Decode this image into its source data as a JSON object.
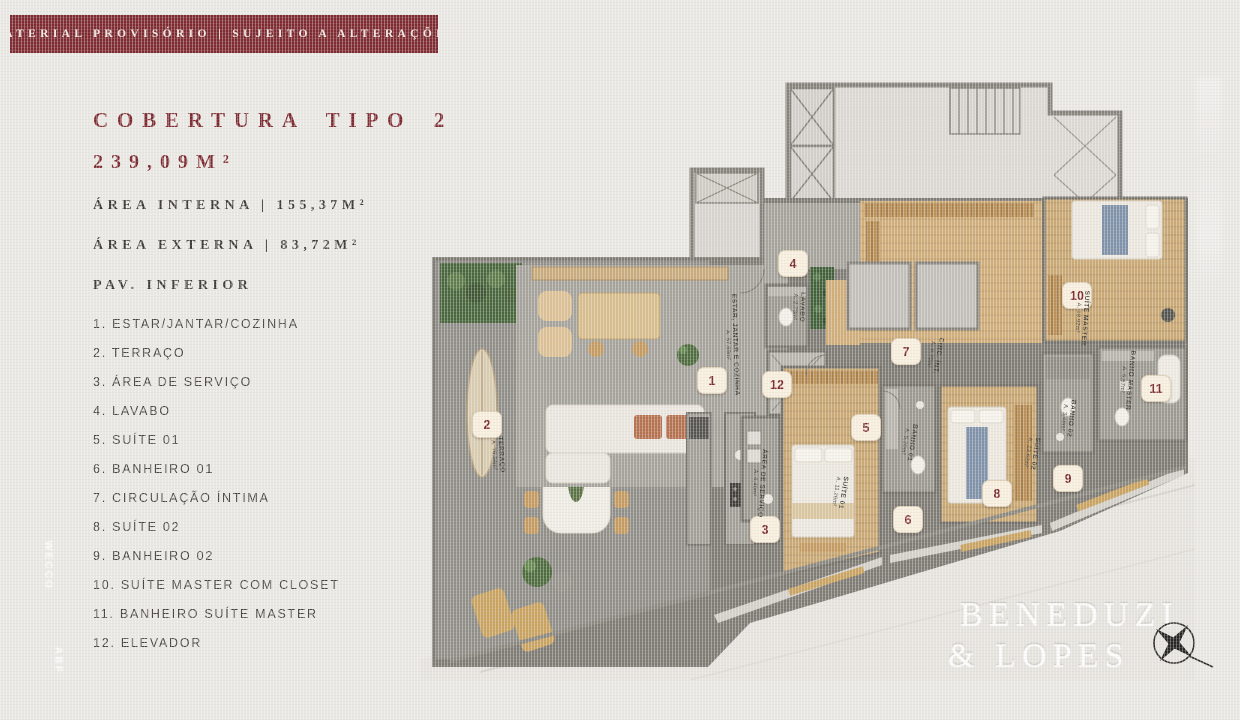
{
  "banner": {
    "text": "MATERIAL PROVISÓRIO | SUJEITO A ALTERAÇÕES"
  },
  "header": {
    "title": "COBERTURA TIPO 2",
    "total_area": "239,09M²",
    "area_interna": "ÁREA INTERNA | 155,37M²",
    "area_externa": "ÁREA EXTERNA | 83,72M²",
    "floor": "PAV. INFERIOR"
  },
  "legend": {
    "items": [
      {
        "num": "1.",
        "label": "ESTAR/JANTAR/COZINHA"
      },
      {
        "num": "2.",
        "label": "TERRAÇO"
      },
      {
        "num": "3.",
        "label": "ÁREA DE SERVIÇO"
      },
      {
        "num": "4.",
        "label": "LAVABO"
      },
      {
        "num": "5.",
        "label": "SUÍTE 01"
      },
      {
        "num": "6.",
        "label": "BANHEIRO 01"
      },
      {
        "num": "7.",
        "label": "CIRCULAÇÃO ÍNTIMA"
      },
      {
        "num": "8.",
        "label": "SUÍTE 02"
      },
      {
        "num": "9.",
        "label": "BANHEIRO 02"
      },
      {
        "num": "10.",
        "label": "SUÍTE MASTER COM CLOSET"
      },
      {
        "num": "11.",
        "label": "BANHEIRO SUÍTE MASTER"
      },
      {
        "num": "12.",
        "label": "ELEVADOR"
      }
    ]
  },
  "plan": {
    "badges": [
      {
        "n": "1",
        "x": 292,
        "y": 325
      },
      {
        "n": "2",
        "x": 67,
        "y": 369
      },
      {
        "n": "3",
        "x": 345,
        "y": 474
      },
      {
        "n": "4",
        "x": 373,
        "y": 208
      },
      {
        "n": "5",
        "x": 446,
        "y": 372
      },
      {
        "n": "6",
        "x": 488,
        "y": 464
      },
      {
        "n": "7",
        "x": 486,
        "y": 296
      },
      {
        "n": "8",
        "x": 577,
        "y": 438
      },
      {
        "n": "9",
        "x": 648,
        "y": 423
      },
      {
        "n": "10",
        "x": 657,
        "y": 240
      },
      {
        "n": "11",
        "x": 736,
        "y": 333
      },
      {
        "n": "12",
        "x": 357,
        "y": 329
      }
    ],
    "rooms": [
      {
        "name": "ESTAR, JANTAR E COZINHA",
        "area": "A. 57,69m²",
        "x": 311,
        "y": 290,
        "rot": 88
      },
      {
        "name": "TERRAÇO",
        "area": "A. 76,34m²",
        "x": 77,
        "y": 400,
        "rot": 86
      },
      {
        "name": "LAVABO",
        "area": "A. 2,73m²",
        "x": 378,
        "y": 252,
        "rot": 92
      },
      {
        "name": "ÁREA DE SERVIÇO",
        "area": "A. 4,40m²",
        "x": 338,
        "y": 428,
        "rot": 94
      },
      {
        "name": "SUÍTE 01",
        "area": "A. 11,26m²",
        "x": 419,
        "y": 437,
        "rot": 99
      },
      {
        "name": "BANHO 01",
        "area": "A. 5,20m²",
        "x": 488,
        "y": 387,
        "rot": 99
      },
      {
        "name": "CIRC. ÍNT.",
        "area": "A. 6,70m²",
        "x": 514,
        "y": 300,
        "rot": 100
      },
      {
        "name": "SUÍTE 02",
        "area": "A. 13,62m²",
        "x": 611,
        "y": 398,
        "rot": 99
      },
      {
        "name": "BANHO 02",
        "area": "A. 3,48m²",
        "x": 647,
        "y": 363,
        "rot": 97
      },
      {
        "name": "SUÍTE MASTER",
        "area": "A. 18,92m²",
        "x": 661,
        "y": 263,
        "rot": 94
      },
      {
        "name": "BANHO MASTER",
        "area": "A. 5,67m²",
        "x": 706,
        "y": 325,
        "rot": 95
      }
    ]
  },
  "branding": {
    "line1": "BENEDUZI",
    "line2": "& LOPES"
  },
  "watermarks": {
    "vertical_logo_1": "WECCO",
    "vertical_logo_2": "ABF"
  },
  "colors": {
    "maroon": "#7d2a31",
    "badge_bg": "#f7eede",
    "badge_text": "#7c2b2e",
    "wood": "#c9a873",
    "paper": "#eae8e4"
  }
}
